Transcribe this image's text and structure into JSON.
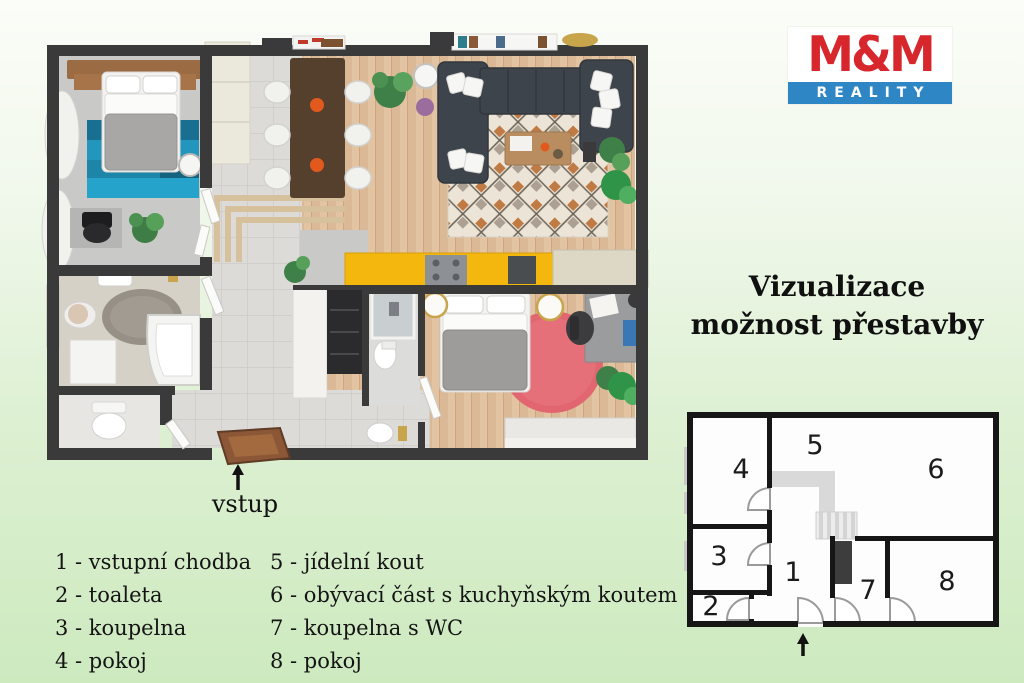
{
  "logo": {
    "text_top": "M&M",
    "text_bottom": "REALITY",
    "color_red": "#d7262c",
    "color_blue": "#2e86c5"
  },
  "title": {
    "line1": "Vizualizace",
    "line2": "možnost přestavby"
  },
  "plan3d": {
    "entrance_label": "vstup"
  },
  "mini": {
    "rooms": [
      "1",
      "2",
      "3",
      "4",
      "5",
      "6",
      "7",
      "8"
    ]
  },
  "legend": {
    "items": [
      "1 - vstupní chodba",
      "2 - toaleta",
      "3 - koupelna",
      "4 - pokoj",
      "5 - jídelní kout",
      "6 - obývací část s kuchyňským koutem",
      "7 - koupelna s WC",
      "8 - pokoj"
    ]
  },
  "colors": {
    "background_green": "#cdeabf",
    "wall": "#3a3a3b",
    "wood_floor": "#dfc09e",
    "tile_floor": "#dcdbd8",
    "teal_rug": "#1d85a8",
    "red_rug": "#e26670",
    "sofa": "#3e444b",
    "kitchen_yellow": "#f4b70d",
    "door_brown": "#8b5737"
  }
}
